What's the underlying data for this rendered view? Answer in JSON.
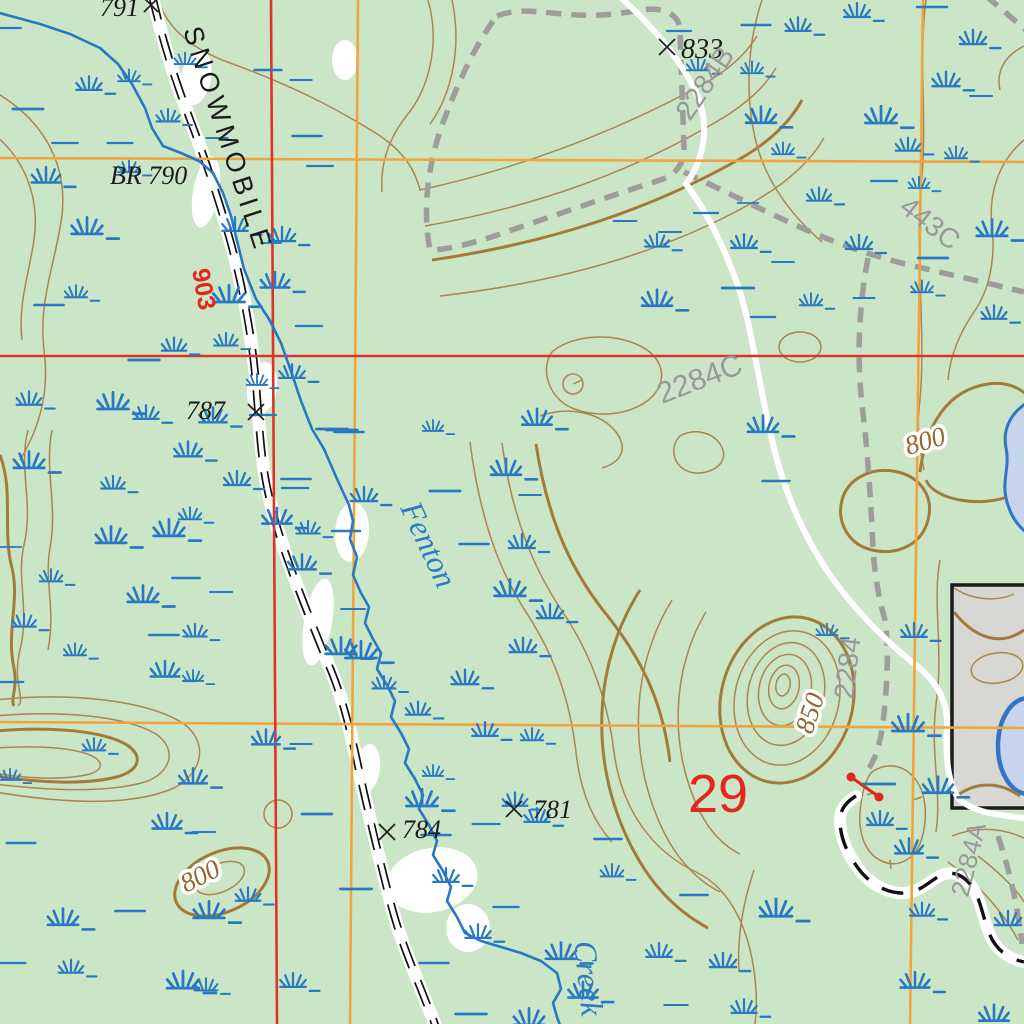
{
  "map": {
    "type": "topographic-map",
    "labels": {
      "trail_name": "SNOWMOBILE",
      "creek_name_upper": "Fenton",
      "creek_name_lower": "Creek",
      "section_number": "29",
      "benchmark": "BR 790",
      "spot_791": "791",
      "spot_787": "787",
      "spot_833": "833",
      "spot_784": "784",
      "spot_781": "781",
      "route_903": "903",
      "trail_2284": "2284",
      "trail_2284A": "2284A",
      "trail_2284B": "2284B",
      "trail_2284C": "2284C",
      "trail_443C": "443C",
      "contour_800_east": "800",
      "contour_800_southwest": "800",
      "contour_850": "850"
    },
    "colors": {
      "map_bg": "#cae6c6",
      "water_blue": "#2878c3",
      "lake_fill": "#c6d4ec",
      "lake_stroke": "#3474c4",
      "contour_brown": "#ab8551",
      "index_brown": "#a37a3c",
      "grid_red": "#e0322a",
      "grid_orange": "#f2a43c",
      "trail_gray": "#9d9d99",
      "label_gray": "#98989a",
      "label_red": "#e5261c",
      "label_brown": "#93682e",
      "label_black": "#1b1b1b",
      "label_blue": "#2e7bc4",
      "pit_fill": "#d7d7d3"
    }
  }
}
